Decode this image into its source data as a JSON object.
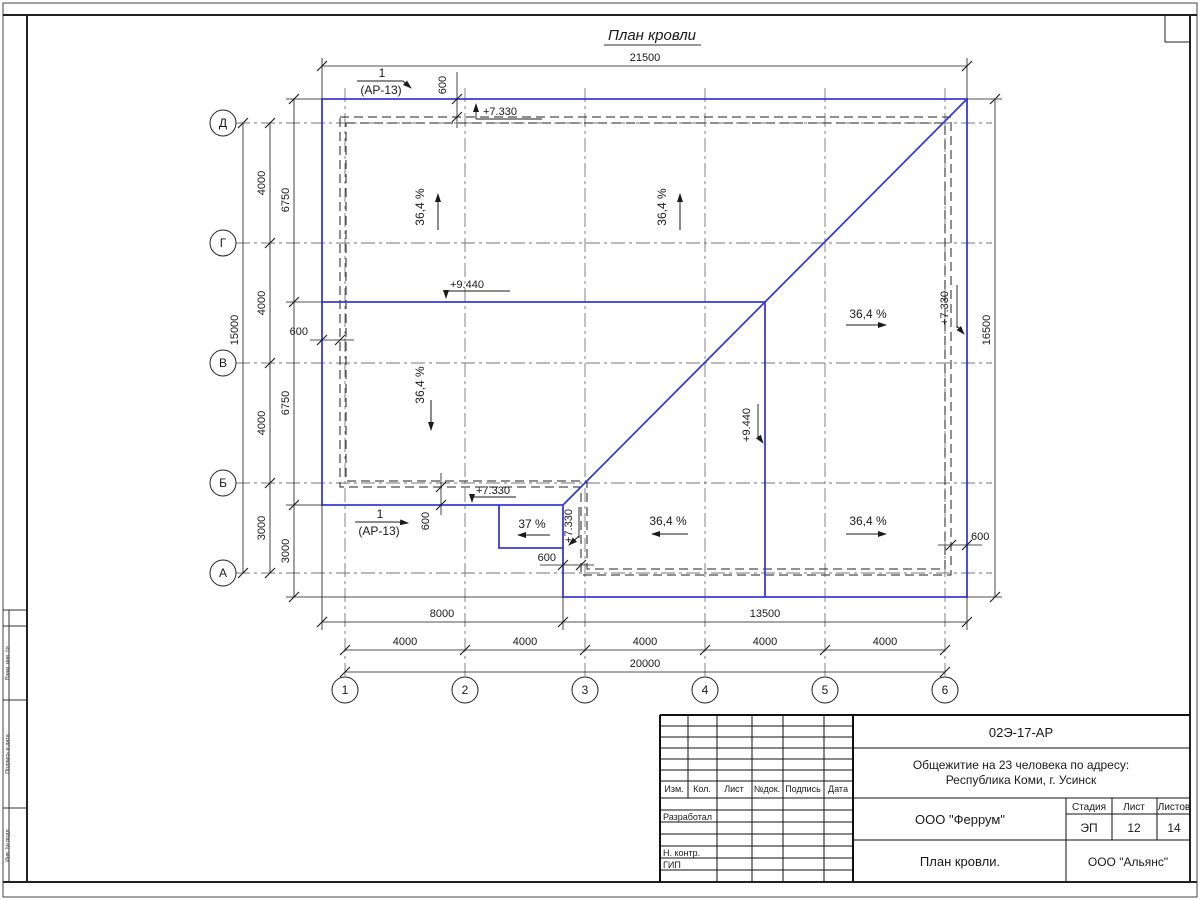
{
  "page": {
    "title": "План кровли"
  },
  "colors": {
    "roof_line": "#3a3ad6",
    "line": "#1a1a1a"
  },
  "drawing": {
    "axes": {
      "rows": [
        "Д",
        "Г",
        "В",
        "Б",
        "А"
      ],
      "cols": [
        "1",
        "2",
        "3",
        "4",
        "5",
        "6"
      ]
    },
    "dims": {
      "top_total": "21500",
      "right_total": "16500",
      "left_total": "15000",
      "left_seg": [
        "4000",
        "4000",
        "4000",
        "3000"
      ],
      "left_inner": [
        "6750",
        "6750",
        "3000"
      ],
      "bottom_spans": [
        "8000",
        "13500"
      ],
      "bottom_cols": [
        "4000",
        "4000",
        "4000",
        "4000",
        "4000"
      ],
      "bottom_total": "20000",
      "overhang": "600"
    },
    "slope_main": "36,4 %",
    "slope_small": "37 %",
    "elev_eave": "+7.330",
    "elev_ridge": "+9.440",
    "detail": {
      "num": "1",
      "sheet": "(АР-13)"
    }
  },
  "sidebar": {
    "labels": [
      "Взам. инв. №",
      "Подпись и дата",
      "Инв. № подл."
    ]
  },
  "titleblock": {
    "doc": "02Э-17-АР",
    "project_line1": "Общежитие на 23 человека по адресу:",
    "project_line2": "Республика Коми, г. Усинск",
    "cols": [
      "Изм.",
      "Кол.",
      "Лист",
      "№док.",
      "Подпись",
      "Дата"
    ],
    "roles": [
      "Разработал",
      "Н. контр.",
      "ГИП"
    ],
    "org": "ООО \"Феррум\"",
    "stage_label": "Стадия",
    "sheet_label": "Лист",
    "sheets_label": "Листов",
    "stage": "ЭП",
    "sheet": "12",
    "sheets": "14",
    "title": "План кровли.",
    "firm": "ООО \"Альянс\""
  }
}
